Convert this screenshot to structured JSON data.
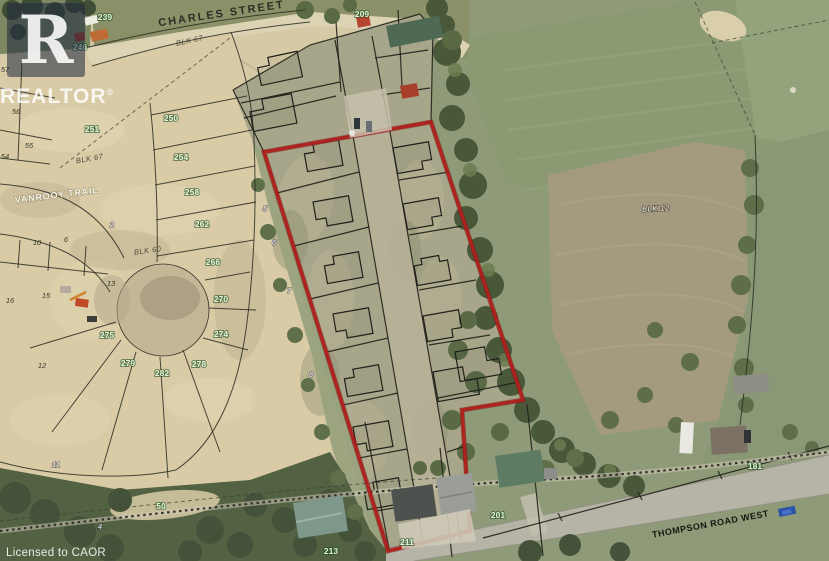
{
  "watermark": {
    "letter": "R",
    "brand": "REALTOR",
    "registered": "®"
  },
  "footer": {
    "license": "Licensed to CAOR"
  },
  "colors": {
    "red_boundary": "#b0201d",
    "label_green": "#def4d4",
    "sand": "#d6c9a5",
    "plan_grass": "#a7a68a",
    "field_green": "#8f9a78",
    "tree_dark": "#4c5a3c",
    "road_gray": "#b6b3a7",
    "line_black": "#20201a"
  },
  "streets": [
    {
      "name": "charles-street",
      "text": "CHARLES STREET",
      "x": 222,
      "y": 17,
      "rot": -8.5
    },
    {
      "name": "vanrooy-trail",
      "text": "VANROOY TRAIL",
      "x": 57,
      "y": 198,
      "rot": -7
    },
    {
      "name": "thompson-road-west",
      "text": "THOMPSON ROAD WEST",
      "x": 711,
      "y": 527,
      "rot": -10.5
    }
  ],
  "lot_labels_green": [
    {
      "text": "239",
      "x": 105,
      "y": 20
    },
    {
      "text": "209",
      "x": 362,
      "y": 17
    },
    {
      "text": "246",
      "x": 80,
      "y": 50
    },
    {
      "text": "250",
      "x": 171,
      "y": 121
    },
    {
      "text": "251",
      "x": 92,
      "y": 132
    },
    {
      "text": "254",
      "x": 181,
      "y": 160
    },
    {
      "text": "258",
      "x": 192,
      "y": 195
    },
    {
      "text": "262",
      "x": 202,
      "y": 227
    },
    {
      "text": "266",
      "x": 213,
      "y": 265
    },
    {
      "text": "270",
      "x": 221,
      "y": 302
    },
    {
      "text": "274",
      "x": 221,
      "y": 337
    },
    {
      "text": "278",
      "x": 199,
      "y": 367
    },
    {
      "text": "282",
      "x": 162,
      "y": 376
    },
    {
      "text": "279",
      "x": 128,
      "y": 366
    },
    {
      "text": "275",
      "x": 107,
      "y": 338
    },
    {
      "text": "181",
      "x": 755,
      "y": 469
    },
    {
      "text": "201",
      "x": 498,
      "y": 518
    },
    {
      "text": "211",
      "x": 407,
      "y": 545
    },
    {
      "text": "213",
      "x": 331,
      "y": 554
    },
    {
      "text": "50",
      "x": 161,
      "y": 509
    }
  ],
  "lot_numbers_dark": [
    {
      "text": "57",
      "x": 5,
      "y": 72
    },
    {
      "text": "56",
      "x": 16,
      "y": 114
    },
    {
      "text": "55",
      "x": 29,
      "y": 148
    },
    {
      "text": "54",
      "x": 5,
      "y": 159
    },
    {
      "text": "10",
      "x": 37,
      "y": 245
    },
    {
      "text": "6",
      "x": 66,
      "y": 242
    },
    {
      "text": "16",
      "x": 10,
      "y": 303
    },
    {
      "text": "15",
      "x": 46,
      "y": 298
    },
    {
      "text": "12",
      "x": 42,
      "y": 368
    },
    {
      "text": "13",
      "x": 111,
      "y": 286
    }
  ],
  "lot_numbers_light": [
    {
      "text": "2",
      "x": 112,
      "y": 227
    },
    {
      "text": "5",
      "x": 265,
      "y": 211
    },
    {
      "text": "6",
      "x": 274,
      "y": 245
    },
    {
      "text": "7",
      "x": 289,
      "y": 293
    },
    {
      "text": "8",
      "x": 311,
      "y": 377
    },
    {
      "text": "11",
      "x": 56,
      "y": 467
    },
    {
      "text": "4",
      "x": 100,
      "y": 529
    }
  ],
  "block_labels": [
    {
      "name": "blk-67-north",
      "text": "BLK 67",
      "x": 190,
      "y": 43,
      "rot": -12
    },
    {
      "name": "blk-67-west",
      "text": "BLK 67",
      "x": 90,
      "y": 161,
      "rot": -10
    },
    {
      "name": "blk-60",
      "text": "BLK 60",
      "x": 148,
      "y": 253,
      "rot": -8
    },
    {
      "name": "blk-12",
      "text": "BLK 12",
      "x": 656,
      "y": 211,
      "rot": -3
    }
  ]
}
